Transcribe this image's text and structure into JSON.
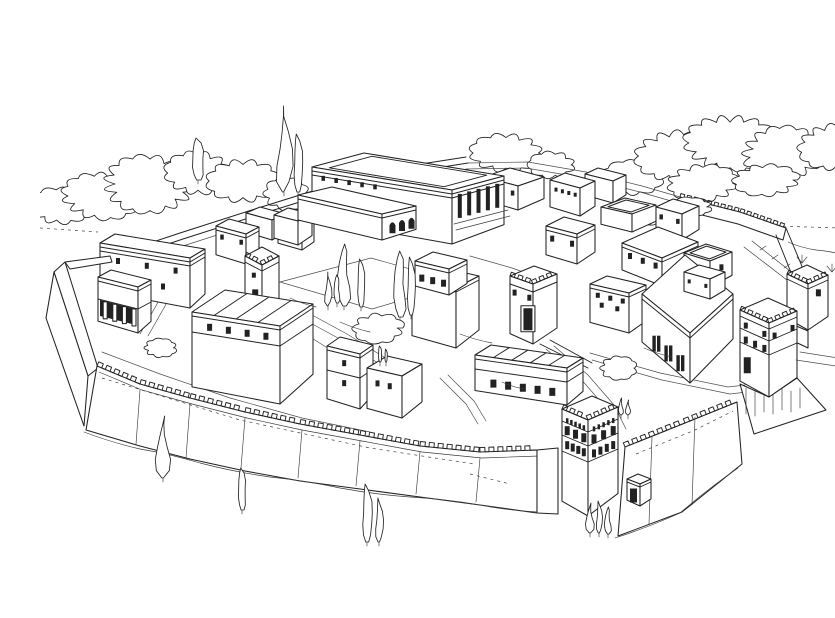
{
  "scene": {
    "subject": "Pen-and-ink reconstruction drawing of a fortified ancient hilltop city seen from above",
    "style": "black ink line art on white paper, no text",
    "elements": [
      "crenellated outer defensive wall",
      "main gate tower",
      "corner tower",
      "upper wall tower",
      "inner gate tower",
      "palace with columned portico and arched annex",
      "flat-roofed courtyard houses",
      "cypress trees",
      "leafy trees and shrubs",
      "roads and lanes",
      "postern door in the wall"
    ]
  },
  "palette": {
    "ink": "#222222",
    "paper": "#ffffff"
  }
}
